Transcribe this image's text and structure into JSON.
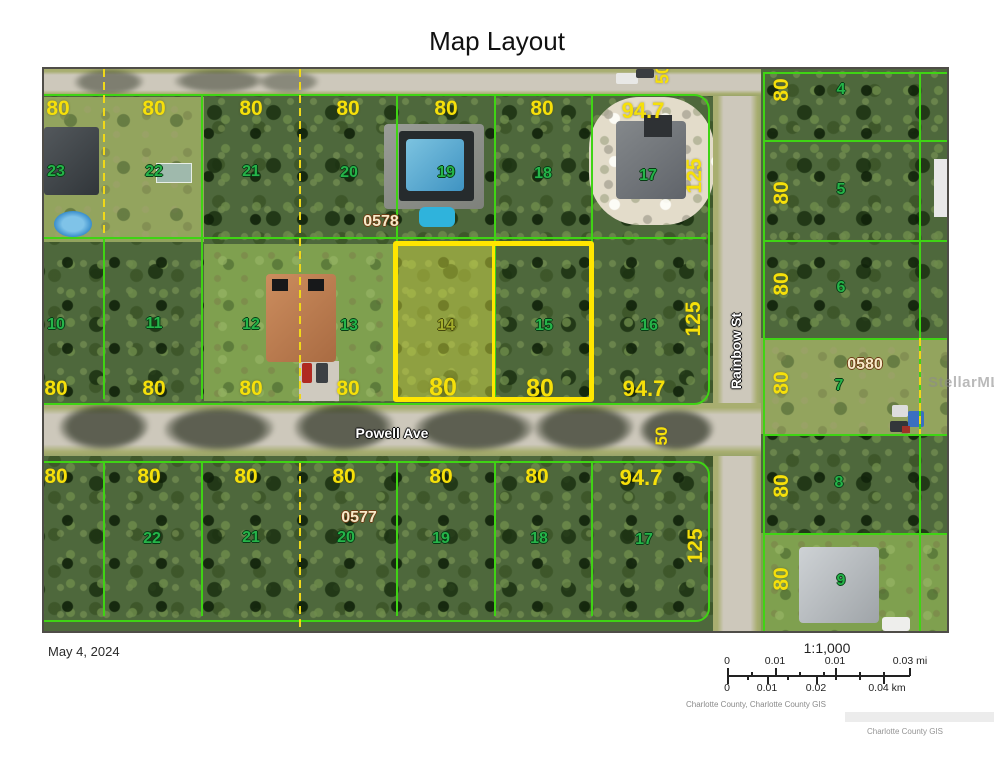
{
  "title": "Map Layout",
  "date": "May 4, 2024",
  "watermark": "StellarMLS",
  "credit": "Charlotte County GIS",
  "attribution": "Charlotte County, Charlotte County GIS",
  "scalebar": {
    "ratio": "1:1,000",
    "rows": [
      {
        "unit": "mi",
        "labels": [
          {
            "t": "0",
            "x": 0
          },
          {
            "t": "0.01",
            "x": 48
          },
          {
            "t": "0.01",
            "x": 108
          },
          {
            "t": "0.03 mi",
            "x": 183
          }
        ]
      },
      {
        "unit": "km",
        "labels": [
          {
            "t": "0",
            "x": 0
          },
          {
            "t": "0.01",
            "x": 40
          },
          {
            "t": "0.02",
            "x": 89
          },
          {
            "t": "0.04 km",
            "x": 160
          }
        ]
      }
    ]
  },
  "colors": {
    "parcel_line": "#3fd414",
    "lot_split_dash": "#f0d818",
    "highlight": "#ffe600",
    "dimension_text": "#f6e00a",
    "lot_text": "#25b449",
    "block_text": "#f7e9c8",
    "street_text": "#ffffff"
  },
  "map": {
    "streets": {
      "powell": "Powell Ave",
      "rainbow": "Rainbow St"
    },
    "highlighted_lots": [
      "14",
      "15"
    ],
    "labels": [
      {
        "t": "80",
        "x": 14,
        "y": 40,
        "k": "dim"
      },
      {
        "t": "80",
        "x": 110,
        "y": 40,
        "k": "dim"
      },
      {
        "t": "80",
        "x": 207,
        "y": 40,
        "k": "dim"
      },
      {
        "t": "80",
        "x": 304,
        "y": 40,
        "k": "dim"
      },
      {
        "t": "80",
        "x": 402,
        "y": 40,
        "k": "dim"
      },
      {
        "t": "80",
        "x": 498,
        "y": 40,
        "k": "dim"
      },
      {
        "t": "94.7",
        "x": 599,
        "y": 42,
        "k": "dim",
        "s": 22
      },
      {
        "t": "125",
        "x": 651,
        "y": 107,
        "k": "dim",
        "r": 1
      },
      {
        "t": "50",
        "x": 619,
        "y": 5,
        "k": "dim",
        "r": 1,
        "s": 18
      },
      {
        "t": "80",
        "x": 12,
        "y": 320,
        "k": "dim"
      },
      {
        "t": "80",
        "x": 110,
        "y": 320,
        "k": "dim"
      },
      {
        "t": "80",
        "x": 207,
        "y": 320,
        "k": "dim"
      },
      {
        "t": "80",
        "x": 304,
        "y": 320,
        "k": "dim"
      },
      {
        "t": "80",
        "x": 399,
        "y": 319,
        "k": "dim",
        "s": 25
      },
      {
        "t": "80",
        "x": 496,
        "y": 320,
        "k": "dim",
        "s": 25
      },
      {
        "t": "94.7",
        "x": 600,
        "y": 320,
        "k": "dim",
        "s": 22
      },
      {
        "t": "125",
        "x": 650,
        "y": 250,
        "k": "dim",
        "r": 1
      },
      {
        "t": "80",
        "x": 12,
        "y": 408,
        "k": "dim"
      },
      {
        "t": "80",
        "x": 105,
        "y": 408,
        "k": "dim"
      },
      {
        "t": "80",
        "x": 202,
        "y": 408,
        "k": "dim"
      },
      {
        "t": "80",
        "x": 300,
        "y": 408,
        "k": "dim"
      },
      {
        "t": "80",
        "x": 397,
        "y": 408,
        "k": "dim"
      },
      {
        "t": "80",
        "x": 493,
        "y": 408,
        "k": "dim"
      },
      {
        "t": "94.7",
        "x": 597,
        "y": 409,
        "k": "dim",
        "s": 22
      },
      {
        "t": "125",
        "x": 652,
        "y": 477,
        "k": "dim",
        "r": 1
      },
      {
        "t": "50",
        "x": 618,
        "y": 367,
        "k": "dim",
        "r": 1,
        "s": 17
      },
      {
        "t": "80",
        "x": 738,
        "y": 21,
        "k": "dim",
        "r": 1
      },
      {
        "t": "80",
        "x": 738,
        "y": 124,
        "k": "dim",
        "r": 1
      },
      {
        "t": "80",
        "x": 738,
        "y": 215,
        "k": "dim",
        "r": 1
      },
      {
        "t": "80",
        "x": 738,
        "y": 314,
        "k": "dim",
        "r": 1
      },
      {
        "t": "80",
        "x": 738,
        "y": 417,
        "k": "dim",
        "r": 1
      },
      {
        "t": "80",
        "x": 738,
        "y": 510,
        "k": "dim",
        "r": 1
      },
      {
        "t": "23",
        "x": 12,
        "y": 103,
        "k": "lot"
      },
      {
        "t": "22",
        "x": 110,
        "y": 103,
        "k": "lot"
      },
      {
        "t": "21",
        "x": 207,
        "y": 103,
        "k": "lot"
      },
      {
        "t": "20",
        "x": 305,
        "y": 104,
        "k": "lot"
      },
      {
        "t": "19",
        "x": 402,
        "y": 104,
        "k": "lot"
      },
      {
        "t": "18",
        "x": 499,
        "y": 105,
        "k": "lot"
      },
      {
        "t": "17",
        "x": 604,
        "y": 107,
        "k": "lot"
      },
      {
        "t": "10",
        "x": 12,
        "y": 256,
        "k": "lot"
      },
      {
        "t": "11",
        "x": 110,
        "y": 255,
        "k": "lot"
      },
      {
        "t": "12",
        "x": 207,
        "y": 256,
        "k": "lot"
      },
      {
        "t": "13",
        "x": 305,
        "y": 257,
        "k": "lot"
      },
      {
        "t": "14",
        "x": 402,
        "y": 257,
        "k": "lot14"
      },
      {
        "t": "15",
        "x": 500,
        "y": 257,
        "k": "lot"
      },
      {
        "t": "16",
        "x": 605,
        "y": 257,
        "k": "lot"
      },
      {
        "t": "22",
        "x": 108,
        "y": 470,
        "k": "lot"
      },
      {
        "t": "21",
        "x": 207,
        "y": 469,
        "k": "lot"
      },
      {
        "t": "20",
        "x": 302,
        "y": 469,
        "k": "lot"
      },
      {
        "t": "19",
        "x": 397,
        "y": 470,
        "k": "lot"
      },
      {
        "t": "18",
        "x": 495,
        "y": 470,
        "k": "lot"
      },
      {
        "t": "17",
        "x": 600,
        "y": 471,
        "k": "lot"
      },
      {
        "t": "4",
        "x": 797,
        "y": 21,
        "k": "lot"
      },
      {
        "t": "5",
        "x": 797,
        "y": 121,
        "k": "lot"
      },
      {
        "t": "6",
        "x": 797,
        "y": 219,
        "k": "lot"
      },
      {
        "t": "7",
        "x": 795,
        "y": 317,
        "k": "lot"
      },
      {
        "t": "8",
        "x": 795,
        "y": 414,
        "k": "lot"
      },
      {
        "t": "9",
        "x": 797,
        "y": 512,
        "k": "lot"
      },
      {
        "t": "0578",
        "x": 337,
        "y": 153,
        "k": "block"
      },
      {
        "t": "0577",
        "x": 315,
        "y": 449,
        "k": "block"
      },
      {
        "t": "0580",
        "x": 821,
        "y": 296,
        "k": "block"
      },
      {
        "t": "Powell Ave",
        "x": 348,
        "y": 364,
        "k": "street"
      },
      {
        "t": "Rainbow St",
        "x": 692,
        "y": 282,
        "k": "street",
        "r": 1
      }
    ]
  }
}
